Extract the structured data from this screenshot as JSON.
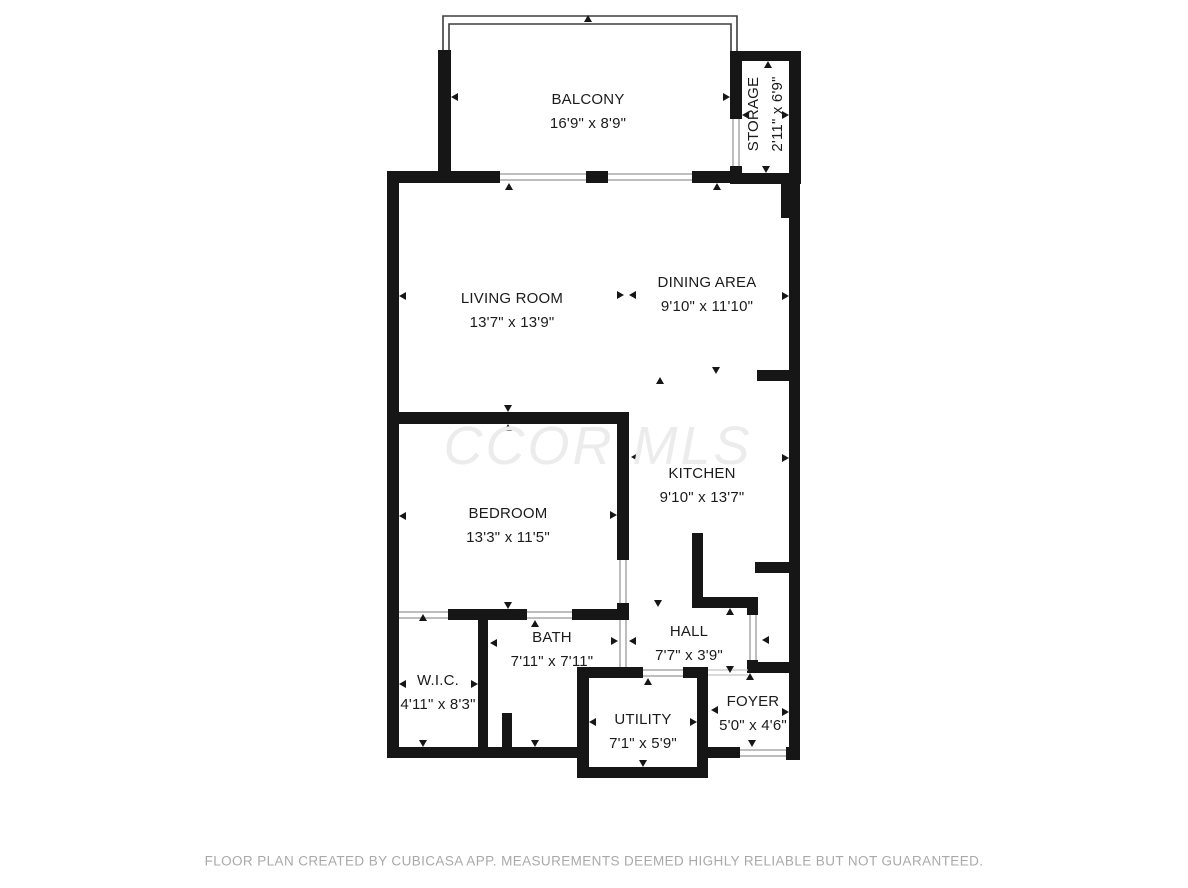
{
  "floor_plan": {
    "watermark": "CCOR MLS",
    "footer": "FLOOR PLAN CREATED BY CUBICASA APP. MEASUREMENTS DEEMED HIGHLY RELIABLE BUT NOT GUARANTEED.",
    "colors": {
      "wall": "#161616",
      "label_text": "#1b1b1b",
      "watermark_text": "#ececec",
      "footer_text": "#a9a9a9",
      "opening_line": "#a9a9a9"
    },
    "rooms": [
      {
        "id": "balcony",
        "name": "BALCONY",
        "dims": "16'9\" x 8'9\""
      },
      {
        "id": "storage",
        "name": "STORAGE",
        "dims": "2'11\" x 6'9\""
      },
      {
        "id": "living-room",
        "name": "LIVING ROOM",
        "dims": "13'7\" x 13'9\""
      },
      {
        "id": "dining-area",
        "name": "DINING AREA",
        "dims": "9'10\" x 11'10\""
      },
      {
        "id": "kitchen",
        "name": "KITCHEN",
        "dims": "9'10\" x 13'7\""
      },
      {
        "id": "bedroom",
        "name": "BEDROOM",
        "dims": "13'3\" x 11'5\""
      },
      {
        "id": "wic",
        "name": "W.I.C.",
        "dims": "4'11\" x 8'3\""
      },
      {
        "id": "bath",
        "name": "BATH",
        "dims": "7'11\" x 7'11\""
      },
      {
        "id": "hall",
        "name": "HALL",
        "dims": "7'7\" x 3'9\""
      },
      {
        "id": "utility",
        "name": "UTILITY",
        "dims": "7'1\" x 5'9\""
      },
      {
        "id": "foyer",
        "name": "FOYER",
        "dims": "5'0\" x 4'6\""
      }
    ]
  }
}
